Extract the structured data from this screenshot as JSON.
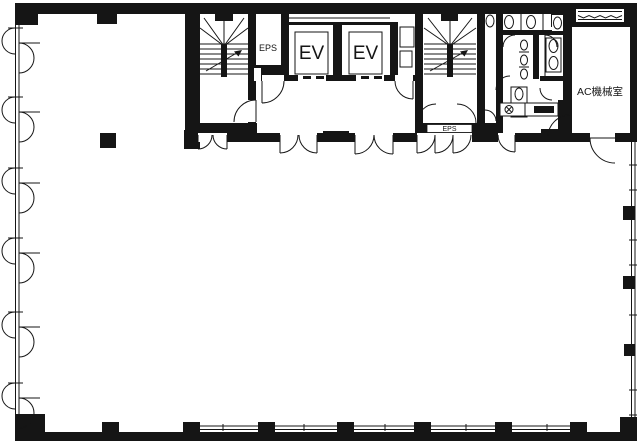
{
  "floor_plan": {
    "labels": {
      "eps_upper": "EPS",
      "elevator_left": "EV",
      "elevator_right": "EV",
      "eps_lower": "EPS",
      "ac_machine_room": "AC機械室"
    },
    "colors": {
      "ink": "#151515",
      "paper": "#ffffff"
    }
  }
}
